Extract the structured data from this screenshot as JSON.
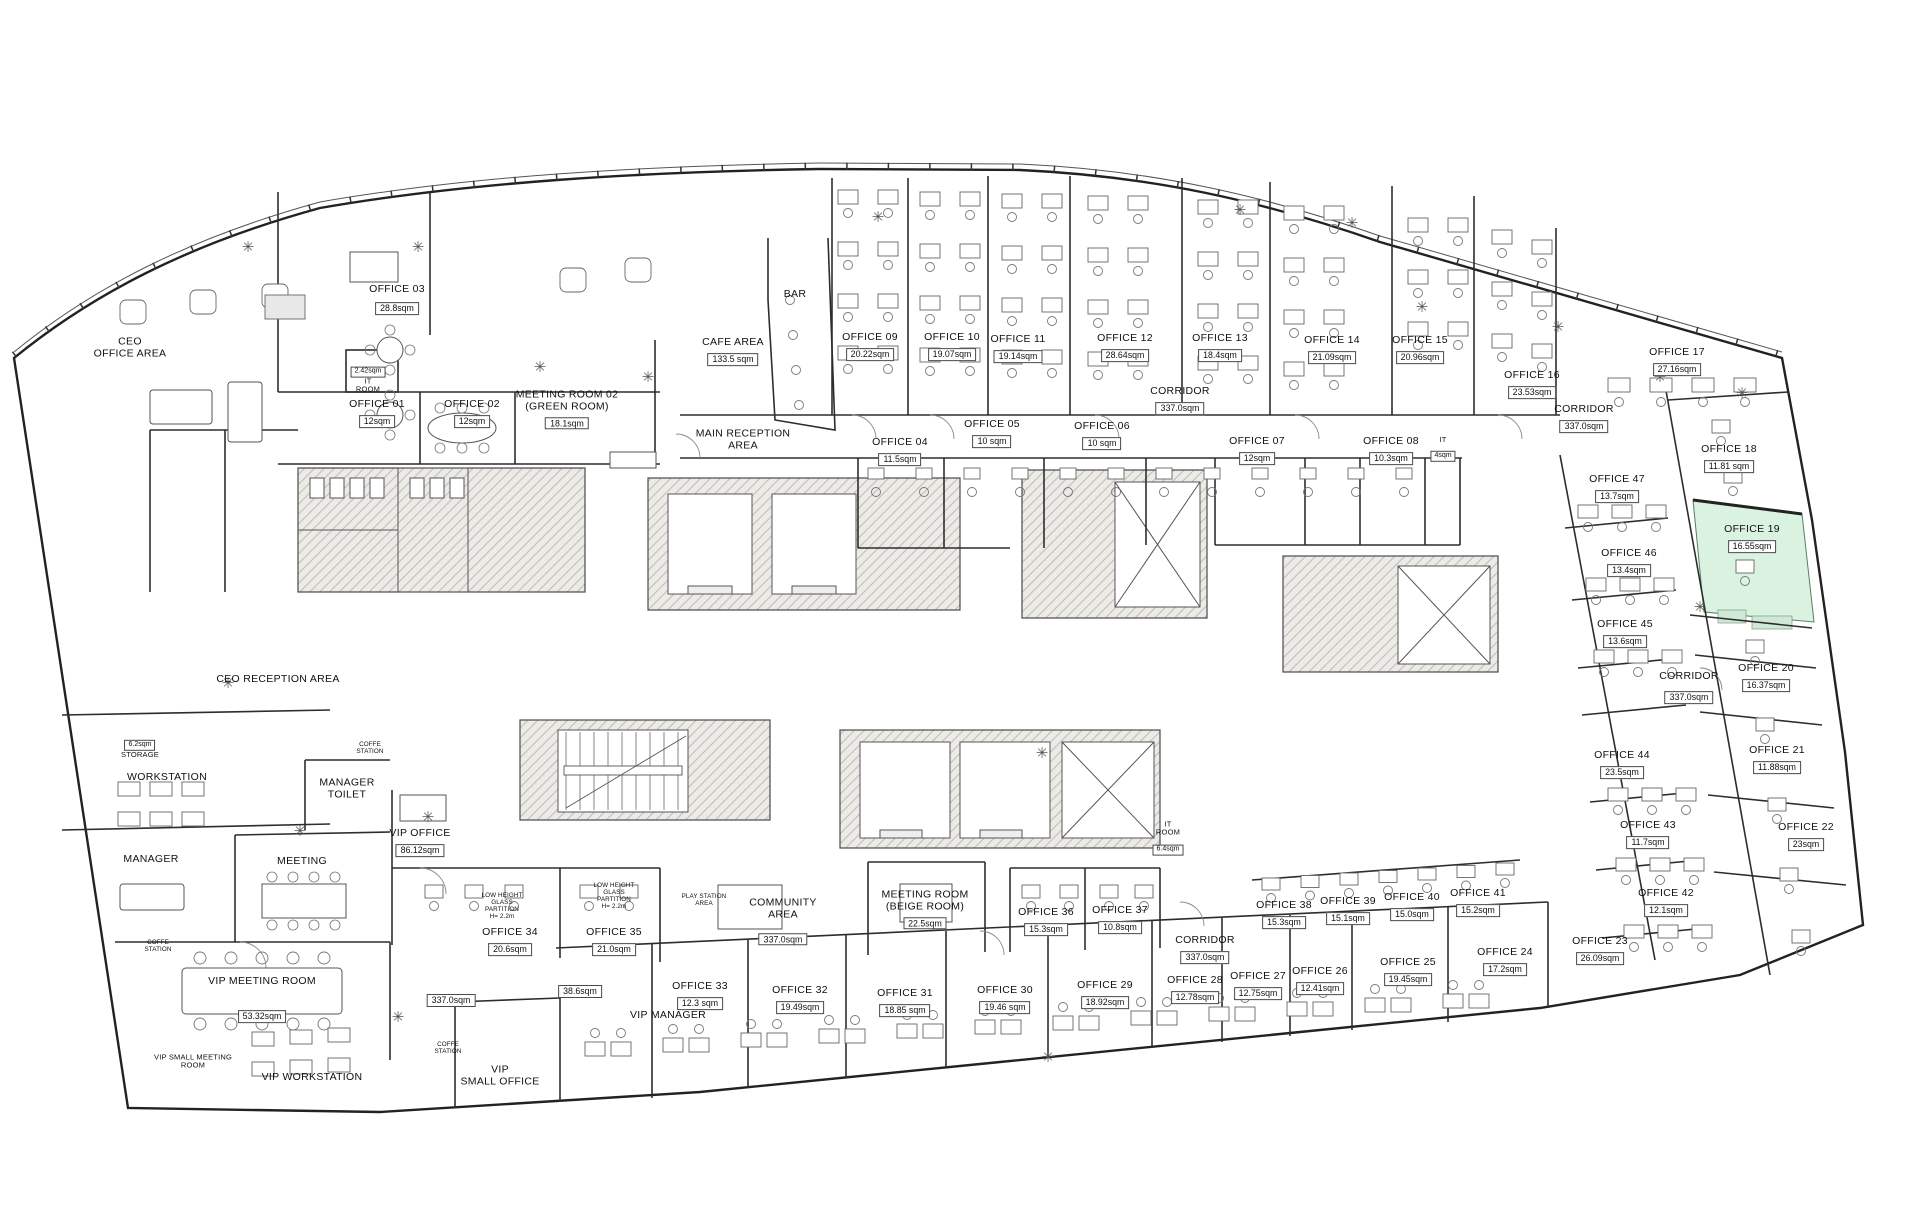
{
  "plan": {
    "type": "architectural office floor plan",
    "highlight_color": "#daf2e0",
    "wall_color": "#222222",
    "core_fill": "#edebe7"
  },
  "rooms": [
    {
      "id": "ceo-office-area",
      "lines": [
        "CEO",
        "OFFICE AREA"
      ],
      "area": null,
      "x": 130,
      "y": 348,
      "cls": ""
    },
    {
      "id": "office-03",
      "lines": [
        "OFFICE 03"
      ],
      "area": "28.8sqm",
      "x": 397,
      "y": 300,
      "cls": "",
      "gap": 6
    },
    {
      "id": "it-room-top",
      "lines": [
        "IT",
        "ROOM"
      ],
      "area": "2.42sqm",
      "x": 368,
      "y": 377,
      "cls": "sm",
      "areaFirst": true
    },
    {
      "id": "office-01",
      "lines": [
        "OFFICE 01"
      ],
      "area": "12sqm",
      "x": 377,
      "y": 414,
      "cls": ""
    },
    {
      "id": "office-02",
      "lines": [
        "OFFICE 02"
      ],
      "area": "12sqm",
      "x": 472,
      "y": 414,
      "cls": ""
    },
    {
      "id": "meeting-room-02",
      "lines": [
        "MEETING ROOM 02",
        "(GREEN ROOM)"
      ],
      "area": "18.1sqm",
      "x": 567,
      "y": 410,
      "cls": ""
    },
    {
      "id": "cafe-area",
      "lines": [
        "CAFE AREA"
      ],
      "area": "133.5 sqm",
      "x": 733,
      "y": 352,
      "cls": ""
    },
    {
      "id": "bar",
      "lines": [
        "BAR"
      ],
      "area": null,
      "x": 795,
      "y": 295,
      "cls": ""
    },
    {
      "id": "main-reception-area",
      "lines": [
        "MAIN RECEPTION",
        "AREA"
      ],
      "area": null,
      "x": 743,
      "y": 440,
      "cls": ""
    },
    {
      "id": "office-09",
      "lines": [
        "OFFICE 09"
      ],
      "area": "20.22sqm",
      "x": 870,
      "y": 347,
      "cls": ""
    },
    {
      "id": "office-10",
      "lines": [
        "OFFICE 10"
      ],
      "area": "19.07sqm",
      "x": 952,
      "y": 347,
      "cls": ""
    },
    {
      "id": "office-11",
      "lines": [
        "OFFICE 11"
      ],
      "area": "19.14sqm",
      "x": 1018,
      "y": 349,
      "cls": ""
    },
    {
      "id": "office-12",
      "lines": [
        "OFFICE 12"
      ],
      "area": "28.64sqm",
      "x": 1125,
      "y": 348,
      "cls": ""
    },
    {
      "id": "office-13",
      "lines": [
        "OFFICE 13"
      ],
      "area": "18.4sqm",
      "x": 1220,
      "y": 348,
      "cls": ""
    },
    {
      "id": "office-14",
      "lines": [
        "OFFICE 14"
      ],
      "area": "21.09sqm",
      "x": 1332,
      "y": 350,
      "cls": ""
    },
    {
      "id": "office-15",
      "lines": [
        "OFFICE 15"
      ],
      "area": "20.96sqm",
      "x": 1420,
      "y": 350,
      "cls": ""
    },
    {
      "id": "office-16",
      "lines": [
        "OFFICE 16"
      ],
      "area": "23.53sqm",
      "x": 1532,
      "y": 385,
      "cls": ""
    },
    {
      "id": "office-17",
      "lines": [
        "OFFICE 17"
      ],
      "area": "27.16sqm",
      "x": 1677,
      "y": 362,
      "cls": ""
    },
    {
      "id": "corridor-top",
      "lines": [
        "CORRIDOR"
      ],
      "area": "337.0sqm",
      "x": 1180,
      "y": 401,
      "cls": ""
    },
    {
      "id": "corridor-right",
      "lines": [
        "CORRIDOR"
      ],
      "area": "337.0sqm",
      "x": 1584,
      "y": 419,
      "cls": ""
    },
    {
      "id": "office-04",
      "lines": [
        "OFFICE 04"
      ],
      "area": "11.5sqm",
      "x": 900,
      "y": 452,
      "cls": ""
    },
    {
      "id": "office-05",
      "lines": [
        "OFFICE 05"
      ],
      "area": "10 sqm",
      "x": 992,
      "y": 434,
      "cls": ""
    },
    {
      "id": "office-06",
      "lines": [
        "OFFICE 06"
      ],
      "area": "10 sqm",
      "x": 1102,
      "y": 436,
      "cls": ""
    },
    {
      "id": "office-07",
      "lines": [
        "OFFICE 07"
      ],
      "area": "12sqm",
      "x": 1257,
      "y": 451,
      "cls": ""
    },
    {
      "id": "office-08",
      "lines": [
        "OFFICE 08"
      ],
      "area": "10.3sqm",
      "x": 1391,
      "y": 451,
      "cls": ""
    },
    {
      "id": "it-closet",
      "lines": [
        "IT"
      ],
      "area": "4sqm",
      "x": 1443,
      "y": 449,
      "cls": "sm"
    },
    {
      "id": "office-18",
      "lines": [
        "OFFICE 18"
      ],
      "area": "11.81 sqm",
      "x": 1729,
      "y": 459,
      "cls": ""
    },
    {
      "id": "office-47",
      "lines": [
        "OFFICE 47"
      ],
      "area": "13.7sqm",
      "x": 1617,
      "y": 489,
      "cls": ""
    },
    {
      "id": "office-19",
      "lines": [
        "OFFICE 19"
      ],
      "area": "16.55sqm",
      "x": 1752,
      "y": 539,
      "cls": ""
    },
    {
      "id": "office-46",
      "lines": [
        "OFFICE 46"
      ],
      "area": "13.4sqm",
      "x": 1629,
      "y": 563,
      "cls": ""
    },
    {
      "id": "office-45",
      "lines": [
        "OFFICE 45"
      ],
      "area": "13.6sqm",
      "x": 1625,
      "y": 634,
      "cls": ""
    },
    {
      "id": "office-20",
      "lines": [
        "OFFICE 20"
      ],
      "area": "16.37sqm",
      "x": 1766,
      "y": 678,
      "cls": ""
    },
    {
      "id": "corridor-mid-right",
      "lines": [
        "CORRIDOR"
      ],
      "area": "337.0sqm",
      "x": 1689,
      "y": 688,
      "cls": "",
      "gap": 8
    },
    {
      "id": "office-21",
      "lines": [
        "OFFICE 21"
      ],
      "area": "11.88sqm",
      "x": 1777,
      "y": 760,
      "cls": ""
    },
    {
      "id": "office-44",
      "lines": [
        "OFFICE 44"
      ],
      "area": "23.5sqm",
      "x": 1622,
      "y": 765,
      "cls": ""
    },
    {
      "id": "office-22",
      "lines": [
        "OFFICE 22"
      ],
      "area": "23sqm",
      "x": 1806,
      "y": 837,
      "cls": ""
    },
    {
      "id": "office-43",
      "lines": [
        "OFFICE 43"
      ],
      "area": "11.7sqm",
      "x": 1648,
      "y": 835,
      "cls": ""
    },
    {
      "id": "office-42",
      "lines": [
        "OFFICE 42"
      ],
      "area": "12.1sqm",
      "x": 1666,
      "y": 903,
      "cls": ""
    },
    {
      "id": "office-23",
      "lines": [
        "OFFICE 23"
      ],
      "area": "26.09sqm",
      "x": 1600,
      "y": 951,
      "cls": ""
    },
    {
      "id": "office-24",
      "lines": [
        "OFFICE 24"
      ],
      "area": "17.2sqm",
      "x": 1505,
      "y": 962,
      "cls": ""
    },
    {
      "id": "office-25",
      "lines": [
        "OFFICE 25"
      ],
      "area": "19.45sqm",
      "x": 1408,
      "y": 972,
      "cls": ""
    },
    {
      "id": "office-26",
      "lines": [
        "OFFICE 26"
      ],
      "area": "12.41sqm",
      "x": 1320,
      "y": 981,
      "cls": ""
    },
    {
      "id": "office-27",
      "lines": [
        "OFFICE 27"
      ],
      "area": "12.75sqm",
      "x": 1258,
      "y": 986,
      "cls": ""
    },
    {
      "id": "office-28",
      "lines": [
        "OFFICE 28"
      ],
      "area": "12.78sqm",
      "x": 1195,
      "y": 990,
      "cls": ""
    },
    {
      "id": "office-29",
      "lines": [
        "OFFICE 29"
      ],
      "area": "18.92sqm",
      "x": 1105,
      "y": 995,
      "cls": ""
    },
    {
      "id": "office-30",
      "lines": [
        "OFFICE 30"
      ],
      "area": "19.46 sqm",
      "x": 1005,
      "y": 1000,
      "cls": ""
    },
    {
      "id": "office-31",
      "lines": [
        "OFFICE 31"
      ],
      "area": "18.85 sqm",
      "x": 905,
      "y": 1003,
      "cls": ""
    },
    {
      "id": "office-32",
      "lines": [
        "OFFICE 32"
      ],
      "area": "19.49sqm",
      "x": 800,
      "y": 1000,
      "cls": ""
    },
    {
      "id": "office-33",
      "lines": [
        "OFFICE 33"
      ],
      "area": "12.3 sqm",
      "x": 700,
      "y": 996,
      "cls": ""
    },
    {
      "id": "office-41",
      "lines": [
        "OFFICE 41"
      ],
      "area": "15.2sqm",
      "x": 1478,
      "y": 903,
      "cls": ""
    },
    {
      "id": "office-40",
      "lines": [
        "OFFICE 40"
      ],
      "area": "15.0sqm",
      "x": 1412,
      "y": 907,
      "cls": ""
    },
    {
      "id": "office-39",
      "lines": [
        "OFFICE 39"
      ],
      "area": "15.1sqm",
      "x": 1348,
      "y": 911,
      "cls": ""
    },
    {
      "id": "office-38",
      "lines": [
        "OFFICE 38"
      ],
      "area": "15.3sqm",
      "x": 1284,
      "y": 915,
      "cls": ""
    },
    {
      "id": "corridor-bottom",
      "lines": [
        "CORRIDOR"
      ],
      "area": "337.0sqm",
      "x": 1205,
      "y": 950,
      "cls": ""
    },
    {
      "id": "office-37",
      "lines": [
        "OFFICE 37"
      ],
      "area": "10.8sqm",
      "x": 1120,
      "y": 920,
      "cls": ""
    },
    {
      "id": "office-36",
      "lines": [
        "OFFICE 36"
      ],
      "area": "15.3sqm",
      "x": 1046,
      "y": 922,
      "cls": ""
    },
    {
      "id": "it-room-bottom",
      "lines": [
        "IT",
        "ROOM"
      ],
      "area": "6.4sqm",
      "x": 1168,
      "y": 838,
      "cls": "sm"
    },
    {
      "id": "meeting-room-beige",
      "lines": [
        "MEETING ROOM",
        "(BEIGE ROOM)"
      ],
      "area": "22.5sqm",
      "x": 925,
      "y": 910,
      "cls": ""
    },
    {
      "id": "community-area",
      "lines": [
        "COMMUNITY",
        "AREA"
      ],
      "area": "337.0sqm",
      "x": 783,
      "y": 922,
      "cls": "",
      "gap": 12
    },
    {
      "id": "office-35",
      "lines": [
        "OFFICE 35"
      ],
      "area": "21.0sqm",
      "x": 614,
      "y": 942,
      "cls": ""
    },
    {
      "id": "office-34",
      "lines": [
        "OFFICE 34"
      ],
      "area": "20.6sqm",
      "x": 510,
      "y": 942,
      "cls": ""
    },
    {
      "id": "vip-office",
      "lines": [
        "VIP OFFICE"
      ],
      "area": "86.12sqm",
      "x": 420,
      "y": 843,
      "cls": ""
    },
    {
      "id": "meeting-room-left",
      "lines": [
        "MEETING"
      ],
      "area": null,
      "x": 302,
      "y": 862,
      "cls": ""
    },
    {
      "id": "manager-room",
      "lines": [
        "MANAGER"
      ],
      "area": null,
      "x": 151,
      "y": 860,
      "cls": ""
    },
    {
      "id": "workstation",
      "lines": [
        "WORKSTATION"
      ],
      "area": null,
      "x": 167,
      "y": 778,
      "cls": ""
    },
    {
      "id": "manager-toilet",
      "lines": [
        "MANAGER",
        "TOILET"
      ],
      "area": null,
      "x": 347,
      "y": 789,
      "cls": ""
    },
    {
      "id": "ceo-reception-area",
      "lines": [
        "CEO RECEPTION AREA"
      ],
      "area": null,
      "x": 278,
      "y": 680,
      "cls": ""
    },
    {
      "id": "storage",
      "lines": [
        "STORAGE"
      ],
      "area": "6.2sqm",
      "x": 140,
      "y": 746,
      "cls": "sm",
      "areaFirst": true
    },
    {
      "id": "coffe-station-1",
      "lines": [
        "COFFE",
        "STATION"
      ],
      "area": null,
      "x": 370,
      "y": 748,
      "cls": "xs"
    },
    {
      "id": "coffe-station-2",
      "lines": [
        "COFFE",
        "STATION"
      ],
      "area": null,
      "x": 158,
      "y": 946,
      "cls": "xs"
    },
    {
      "id": "coffe-station-3",
      "lines": [
        "COFFE",
        "STATION"
      ],
      "area": null,
      "x": 448,
      "y": 1048,
      "cls": "xs"
    },
    {
      "id": "vip-meeting-room",
      "lines": [
        "VIP MEETING ROOM"
      ],
      "area": "53.32sqm",
      "x": 262,
      "y": 1000,
      "cls": "",
      "gap": 22
    },
    {
      "id": "corridor-area-bottom-left",
      "lines": [],
      "area": "337.0sqm",
      "x": 451,
      "y": 999,
      "cls": ""
    },
    {
      "id": "vip-small-meeting-room",
      "lines": [
        "VIP SMALL MEETING",
        "ROOM"
      ],
      "area": null,
      "x": 193,
      "y": 1062,
      "cls": "sm"
    },
    {
      "id": "vip-workstation",
      "lines": [
        "VIP WORKSTATION"
      ],
      "area": null,
      "x": 312,
      "y": 1078,
      "cls": ""
    },
    {
      "id": "vip-small-office-area",
      "lines": [],
      "area": "38.6sqm",
      "x": 580,
      "y": 990,
      "cls": ""
    },
    {
      "id": "vip-small-office",
      "lines": [
        "VIP",
        "SMALL OFFICE"
      ],
      "area": null,
      "x": 500,
      "y": 1076,
      "cls": ""
    },
    {
      "id": "vip-manager",
      "lines": [
        "VIP MANAGER"
      ],
      "area": null,
      "x": 668,
      "y": 1016,
      "cls": ""
    },
    {
      "id": "partition-note-1",
      "lines": [
        "LOW HEIGHT",
        "GLASS",
        "PARTITION",
        "H= 2.2m"
      ],
      "area": null,
      "x": 502,
      "y": 906,
      "cls": "xs"
    },
    {
      "id": "partition-note-2",
      "lines": [
        "LOW HEIGHT",
        "GLASS",
        "PARTITION",
        "H= 2.2m"
      ],
      "area": null,
      "x": 614,
      "y": 896,
      "cls": "xs"
    },
    {
      "id": "play-station-area",
      "lines": [
        "PLAY STATION",
        "AREA"
      ],
      "area": null,
      "x": 704,
      "y": 900,
      "cls": "xs"
    }
  ]
}
